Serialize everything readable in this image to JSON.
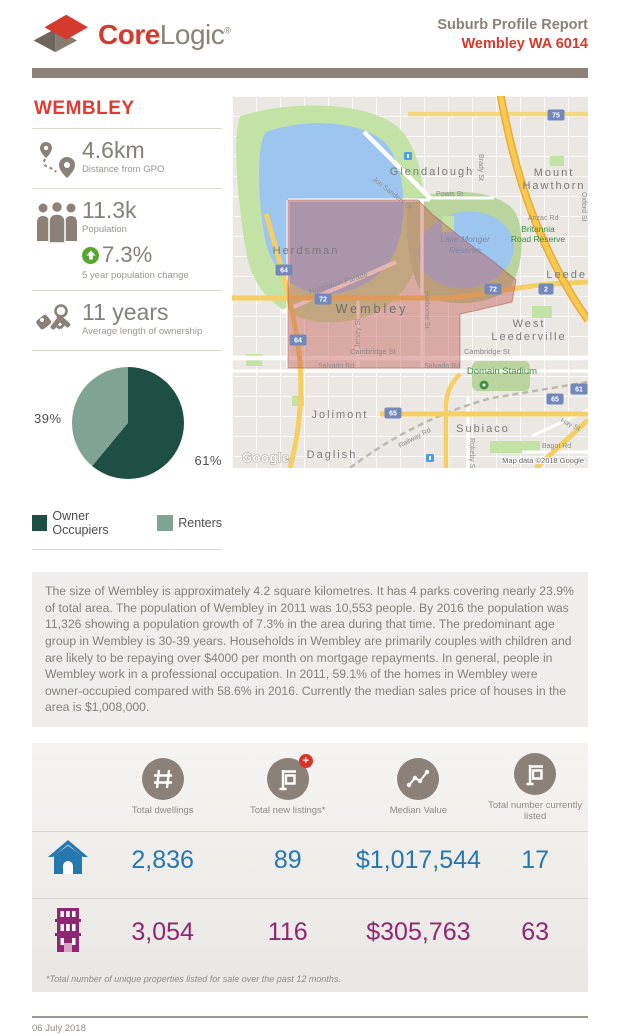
{
  "brand": {
    "core": "Core",
    "logic": "Logic",
    "reg": "®"
  },
  "header": {
    "report_title": "Suburb Profile Report",
    "suburb_line": "Wembley WA 6014"
  },
  "sidebar": {
    "suburb": "WEMBLEY",
    "stats": [
      {
        "value": "4.6km",
        "label": "Distance from GPO"
      },
      {
        "value": "11.3k",
        "label": "Population",
        "change": "7.3%",
        "change_label": "5 year population change"
      },
      {
        "value": "11 years",
        "label": "Average length of ownership"
      }
    ]
  },
  "chart_data": {
    "type": "pie",
    "labels": [
      "Owner Occupiers",
      "Renters"
    ],
    "values": [
      61,
      39
    ],
    "value_labels": [
      "61%",
      "39%"
    ],
    "colors": [
      "#1d4f44",
      "#7fa394"
    ],
    "legend_position": "bottom"
  },
  "map": {
    "labels": [
      "Herdsman",
      "Glendalough",
      "Mount",
      "Hawthorn",
      "Wembley",
      "West",
      "Leederville",
      "Jolimont",
      "Subiaco",
      "Daglish",
      "Leede",
      "Lake Monger",
      "Reserve",
      "Britannia",
      "Road Reserve",
      "Anzac Rd",
      "Powis St",
      "Jon Sanders Dr",
      "Herdsman Parade",
      "Harborne St",
      "Jersey St",
      "Cambridge St",
      "Cambridge St",
      "Salvado Rd",
      "Salvado Rd",
      "Domain Stadium",
      "Railway Rd",
      "Hay St",
      "Bagot Rd",
      "Brady St",
      "Oxford St",
      "Rokeby St"
    ],
    "shields": [
      "64",
      "72",
      "64",
      "72",
      "65",
      "65",
      "61",
      "75",
      "2"
    ],
    "google": "Google",
    "attribution": "Map data ©2018 Google"
  },
  "description": "The size of Wembley is approximately 4.2 square kilometres. It has 4 parks covering nearly 23.9% of total area. The population of Wembley in 2011 was 10,553 people. By 2016 the population was 11,326 showing a population growth of 7.3% in the area during that time. The predominant age group in Wembley is 30-39 years. Households in Wembley are primarily couples with children and are likely to be repaying over $4000 per month on mortgage repayments. In general, people in Wembley work in a professional occupation. In 2011, 59.1% of the homes in Wembley were owner-occupied compared with 58.6% in 2016. Currently the median sales price of houses in the area is $1,008,000.",
  "stats_table": {
    "columns": [
      {
        "icon": "hash-icon",
        "label": "Total dwellings"
      },
      {
        "icon": "listing-plus-icon",
        "label": "Total new listings*"
      },
      {
        "icon": "trend-icon",
        "label": "Median Value"
      },
      {
        "icon": "listing-icon",
        "label": "Total number currently listed"
      }
    ],
    "rows": [
      {
        "property_type": "houses",
        "values": [
          "2,836",
          "89",
          "$1,017,544",
          "17"
        ]
      },
      {
        "property_type": "units",
        "values": [
          "3,054",
          "116",
          "$305,763",
          "63"
        ]
      }
    ],
    "footnote": "*Total number of unique properties listed for sale over the past 12 months.",
    "plus_badge": "+"
  },
  "footer": {
    "date": "06 July 2018"
  },
  "colors": {
    "brand_red": "#e23c30",
    "brand_gray": "#8b8178",
    "houses_blue": "#2577ae",
    "units_purple": "#8f2573",
    "pie_dark": "#1d4f44",
    "pie_light": "#7fa394",
    "growth_green": "#58a62f",
    "overlay_red": "#c0504d"
  }
}
